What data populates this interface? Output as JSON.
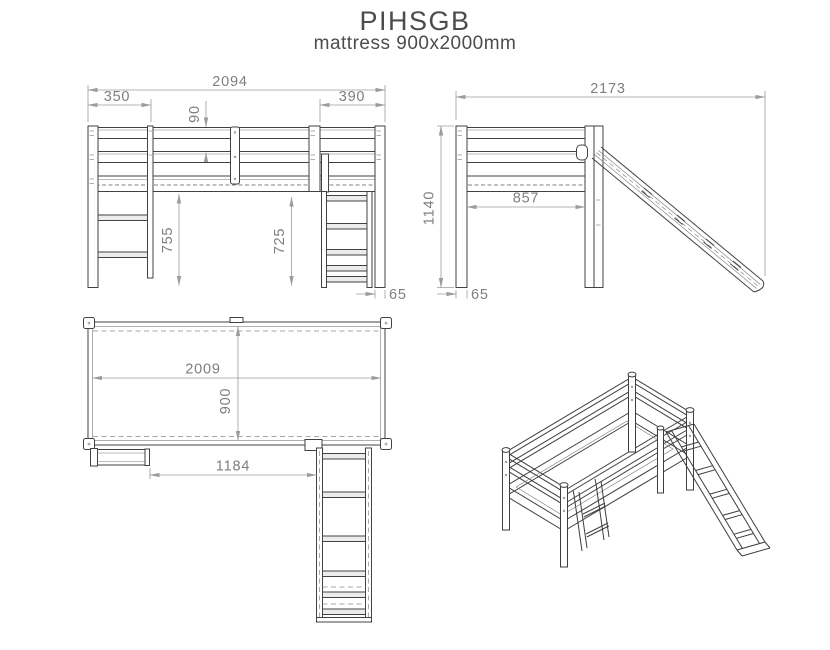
{
  "title": "PIHSGB",
  "subtitle": "mattress 900x2000mm",
  "colors": {
    "background": "#ffffff",
    "drawing_line": "#424242",
    "dimension_line": "#9b9b9b",
    "dimension_text": "#7e7e7e",
    "title_text": "#4c4c4c"
  },
  "views": {
    "front_elevation": {
      "dimensions": {
        "overall_width": "2094",
        "ladder_offset": "350",
        "rail_gap": "90",
        "slide_offset": "390",
        "underbed_height_left": "755",
        "underbed_height_right": "725",
        "post_width": "65"
      }
    },
    "side_elevation": {
      "dimensions": {
        "overall_depth_with_slide": "2173",
        "overall_height": "1140",
        "inner_width": "857",
        "post_width": "65"
      }
    },
    "plan_view": {
      "dimensions": {
        "inner_length": "2009",
        "inner_width": "900",
        "ladder_to_slide": "1184"
      }
    }
  }
}
